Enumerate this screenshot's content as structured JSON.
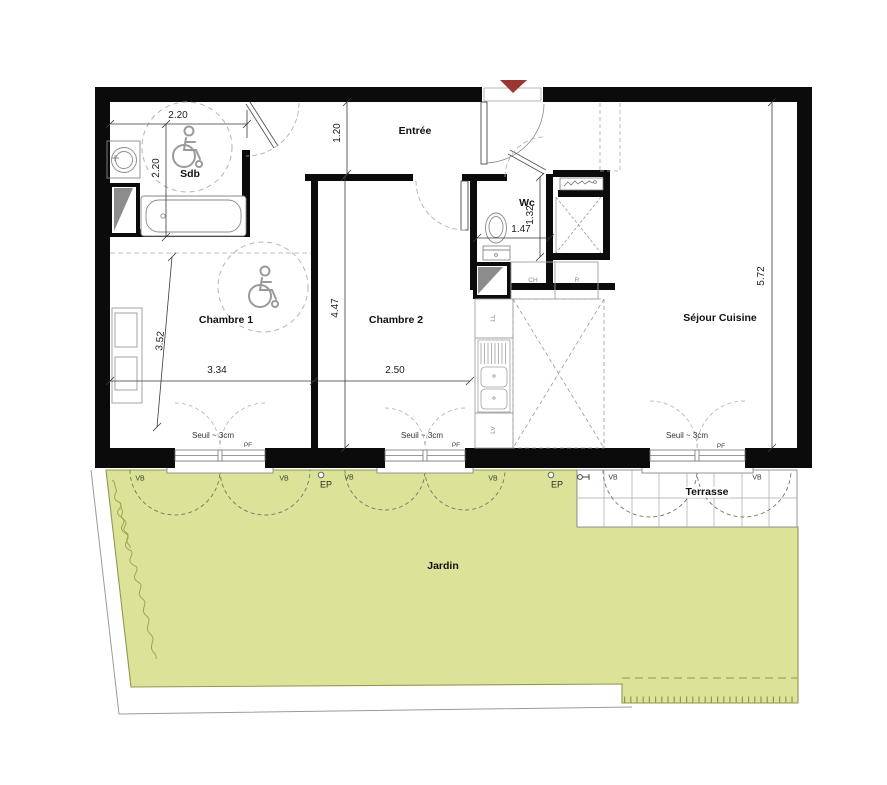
{
  "title": "Plan appartement T3 avec jardin",
  "colors": {
    "garden": "#dce398",
    "gardenLine": "#8f994e",
    "veg": "#9aa94f",
    "wall": "#0b0b0b",
    "arrow": "#9a3733",
    "line": "#3a3a3a",
    "light": "#8a8a8a"
  },
  "rooms": {
    "entree": "Entrée",
    "sdb": "Sdb",
    "wc": "Wc",
    "chambre1": "Chambre 1",
    "chambre2": "Chambre 2",
    "sejour": "Séjour Cuisine",
    "terrasse": "Terrasse",
    "jardin": "Jardin"
  },
  "dimensions": {
    "sdb_width": "2.20",
    "sdb_depth": "2.20",
    "hall_width": "1.20",
    "ch1_width": "3.34",
    "ch1_depth": "3.52",
    "ch2_width": "2.50",
    "ch2_depth": "4.47",
    "wc_width": "1.47",
    "wc_depth": "1.32",
    "sejour_depth": "5.72"
  },
  "windows": {
    "seuil": "Seuil ~ 3cm",
    "pf": "PF",
    "vb": "VB",
    "ep": "EP"
  },
  "appliances": {
    "ch": "CH",
    "r": "R",
    "ll": "LL",
    "lv": "LV"
  }
}
